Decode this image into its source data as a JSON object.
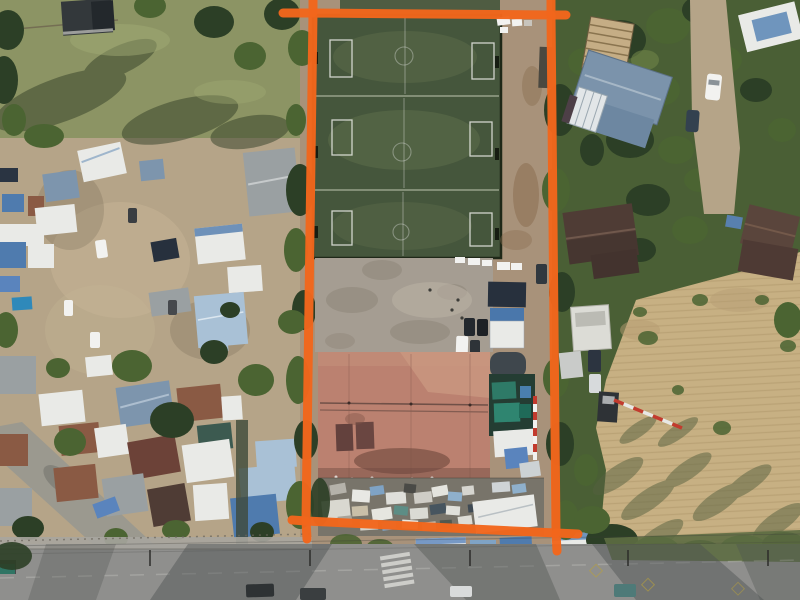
{
  "scene": {
    "type": "aerial-drone-photograph",
    "annotated_parcel_contents": [
      "soccer-fields",
      "gravel-lot",
      "clay-courts",
      "tarp-shelters",
      "storage-yard"
    ],
    "surroundings": [
      "residential-neighborhood-west",
      "tree-covered-lots-east",
      "dry-harvested-field-southeast",
      "paved-road-south"
    ]
  },
  "annotation": {
    "label": "property-boundary",
    "color": "#f2661c",
    "stroke_width": 9,
    "outline_points": "313,13 551,15 556,533 306,521",
    "corner_ticks_path": "M283,13 L313,13 M313,-4 L313,13 M551,15 L566,15 M551,-4 L551,15 M556,533 L578,534 M556,533 L557,551 M306,521 L292,520 M306,521 L307,539"
  },
  "palette": {
    "orange": "#f2661c",
    "grass": "#8c9464",
    "dirt": "#b5a488",
    "dirt2": "#a8927a",
    "gravel": "#a59d92",
    "turf": "#45563c",
    "turf_light": "#5f6f4c",
    "turf_line": "#d9dfc9",
    "clay": "#bb8170",
    "clay_light": "#cb9a82",
    "clay_dark": "#63413d",
    "road": "#8f8f8d",
    "sidewalk": "#a7a59e",
    "dry": "#c7b083",
    "dry_stripe": "#ab9266",
    "canopy": "#4a5f35",
    "tree_dark": "#2c3f26",
    "tree_mid": "#4b6432",
    "tree_light": "#6f8448",
    "roof_white": "#e9eae7",
    "roof_gray": "#9aa0a2",
    "roof_blue": "#4f7bae",
    "roof_lightblue": "#a9c1d6",
    "roof_steel": "#7d95ad",
    "roof_navy": "#27303d",
    "roof_rust": "#8a5a44",
    "roof_darkred": "#6c4238",
    "roof_brown": "#4f3c35",
    "tarp_teal": "#2e7a67",
    "tarp_blue": "#5a84bd",
    "pool": "#2f89ba",
    "white": "#f2f2f0",
    "red": "#c23b2e",
    "scrap": "#78746a"
  }
}
